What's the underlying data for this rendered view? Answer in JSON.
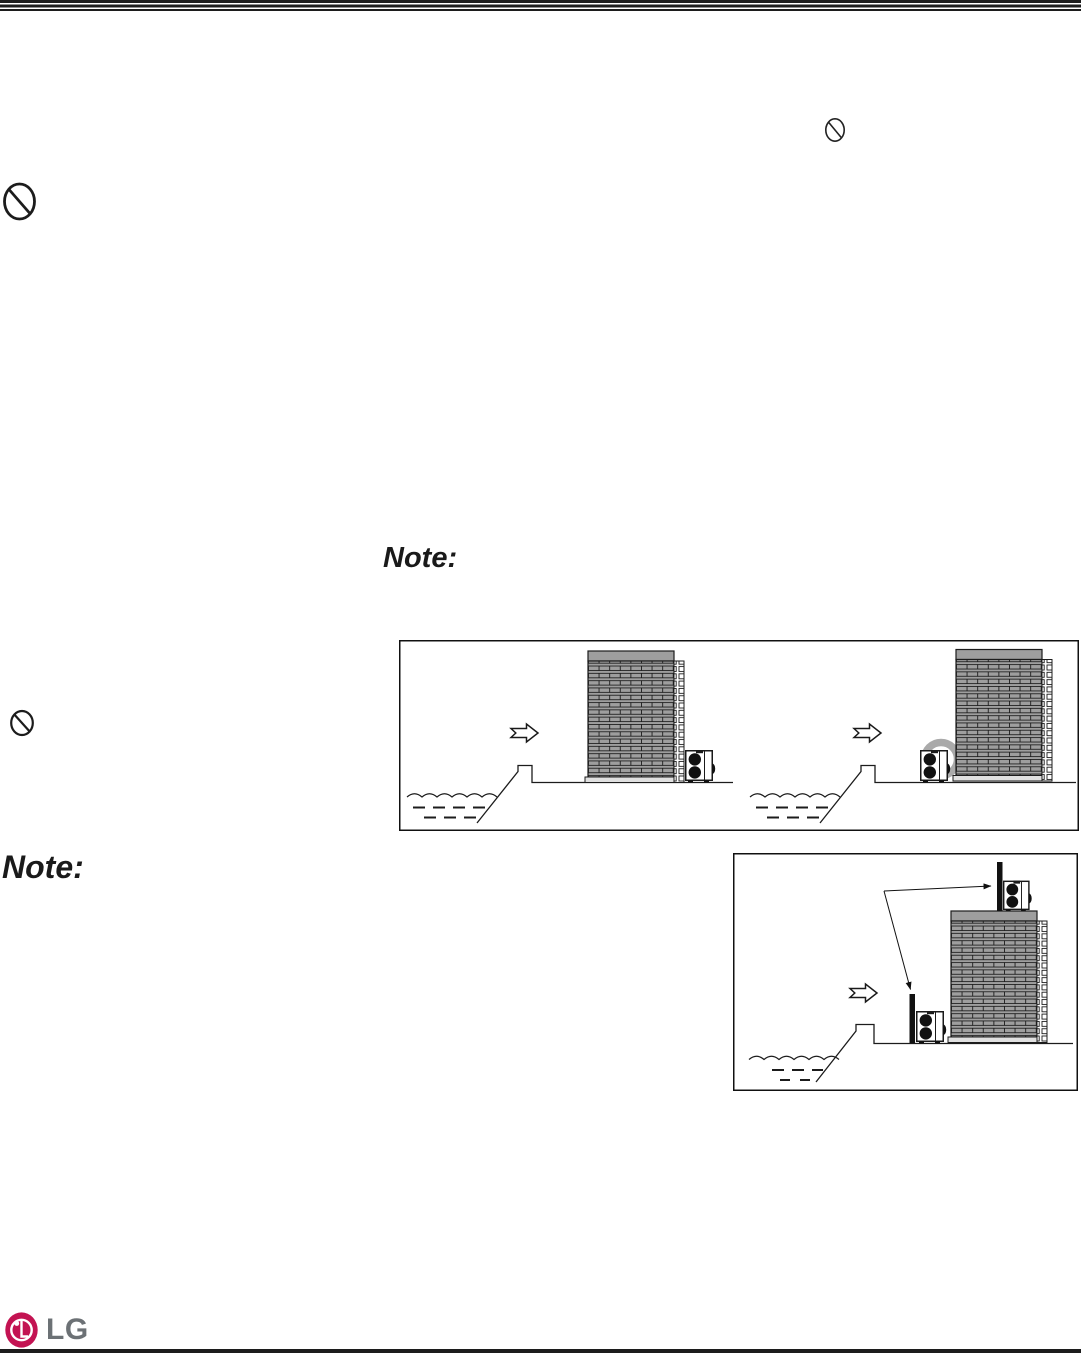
{
  "notes": {
    "note1": "Note:",
    "note2": "Note:"
  },
  "footer": {
    "logo_text": "LG"
  },
  "icons": {
    "prohibition_top_right": "prohibition-icon",
    "prohibition_left_upper": "prohibition-icon",
    "prohibition_left_lower": "prohibition-icon",
    "seawind_arrow": "block-arrow-right-icon",
    "lg_emblem": "lg-logo-icon"
  },
  "colors": {
    "line_black": "#1c1c1c",
    "building_gray": "#9e9e9e",
    "plinth_gray": "#e0e0e0",
    "ring_gray": "#aaaaaa",
    "lg_crimson": "#c31352",
    "lg_text_gray": "#6c7175"
  }
}
